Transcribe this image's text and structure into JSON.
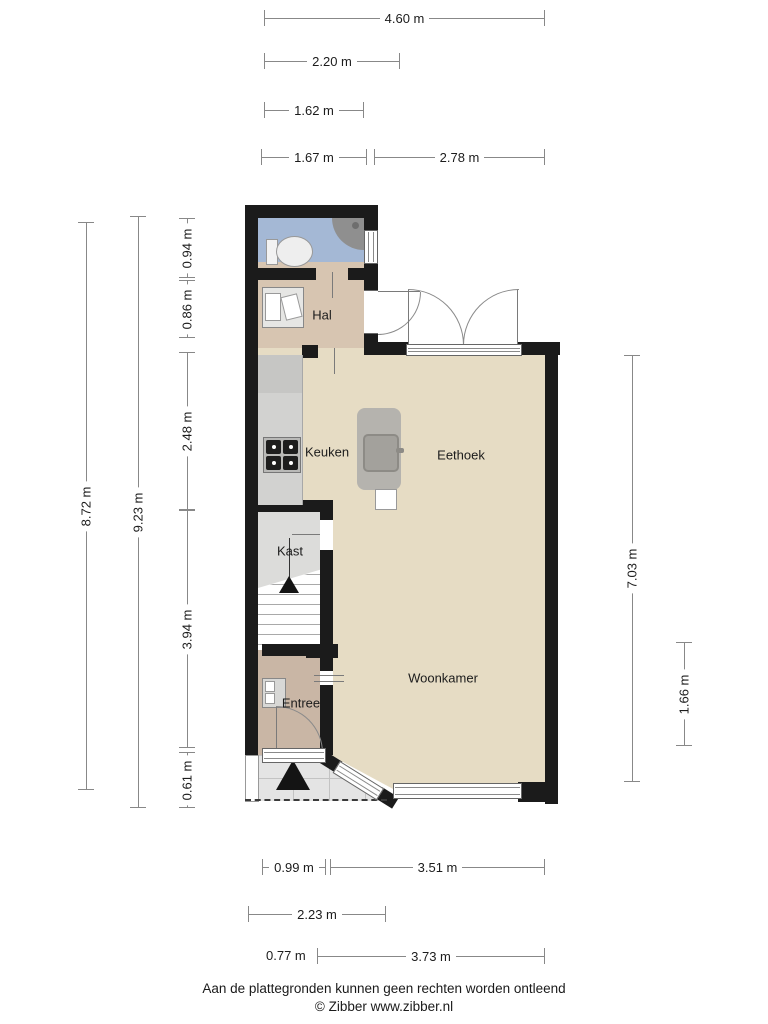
{
  "plan": {
    "type": "floorplan",
    "rooms": {
      "hal": {
        "label": "Hal"
      },
      "keuken": {
        "label": "Keuken"
      },
      "eethoek": {
        "label": "Eethoek"
      },
      "kast": {
        "label": "Kast"
      },
      "woonkamer": {
        "label": "Woonkamer"
      },
      "entree": {
        "label": "Entree"
      }
    },
    "fixtures": [
      "toilet",
      "shower",
      "sink-cabinet",
      "stove",
      "kitchen-island",
      "island-sink",
      "chair",
      "stairs",
      "meter-cabinet",
      "entrance-arrow"
    ]
  },
  "dimensions": {
    "top": [
      {
        "label": "4.60 m"
      },
      {
        "label": "2.20 m"
      },
      {
        "label": "1.62 m"
      },
      {
        "label": "1.67 m"
      },
      {
        "label": "2.78 m"
      }
    ],
    "left": [
      {
        "label": "8.72 m"
      },
      {
        "label": "9.23 m"
      },
      {
        "label": "0.94 m"
      },
      {
        "label": "0.86 m"
      },
      {
        "label": "2.48 m"
      },
      {
        "label": "3.94 m"
      },
      {
        "label": "0.61 m"
      }
    ],
    "right": [
      {
        "label": "7.03 m"
      },
      {
        "label": "1.66 m"
      }
    ],
    "bottom": [
      {
        "label": "0.99 m"
      },
      {
        "label": "3.51 m"
      },
      {
        "label": "2.23 m"
      },
      {
        "label": "0.77 m"
      },
      {
        "label": "3.73 m"
      }
    ]
  },
  "footer": {
    "disclaimer": "Aan de plattegronden kunnen geen rechten worden ontleend",
    "credit": "© Zibber www.zibber.nl"
  },
  "colors": {
    "wall": "#1b1b1b",
    "floor_main": "#e6dcc4",
    "floor_hal": "#d7c5b1",
    "floor_entree": "#c9b6a5",
    "floor_bathroom": "#a4b8d5",
    "floor_kast": "#dcdcda",
    "counter": "#d2d2d0",
    "counter_dark": "#c6c6c4",
    "island": "#b5b3ae",
    "island_sink": "#a3a19c",
    "shower": "#8f8f8f",
    "porch": "#e4e4e4",
    "dim_line": "#888888",
    "text": "#1c1c1c"
  }
}
